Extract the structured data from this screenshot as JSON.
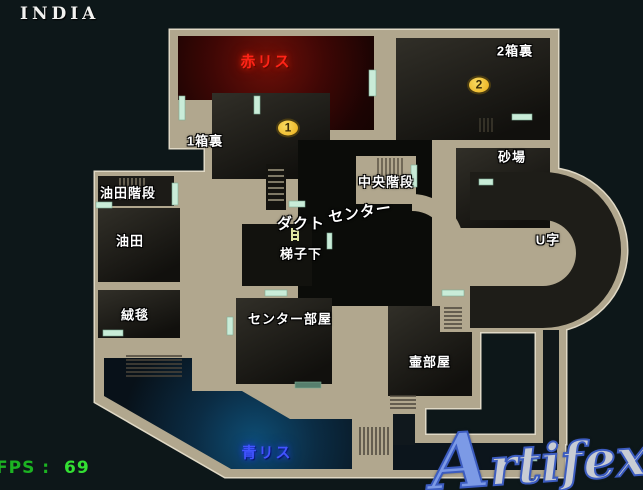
{
  "title": "INDIA",
  "hud": {
    "fps_label": "FPS :",
    "fps_value": "69"
  },
  "watermark": "Artifex",
  "spawns": {
    "red": {
      "label": "赤リス",
      "color": "#ff2418"
    },
    "blue": {
      "label": "青リス",
      "color": "#4254ff"
    }
  },
  "markers": [
    {
      "number": "1"
    },
    {
      "number": "2"
    }
  ],
  "rooms": [
    {
      "id": "2hako-ura",
      "label": "2箱裏"
    },
    {
      "id": "sunaba",
      "label": "砂場"
    },
    {
      "id": "1hako-ura",
      "label": "1箱裏"
    },
    {
      "id": "yuden-kaidan",
      "label": "油田階段"
    },
    {
      "id": "yuden",
      "label": "油田"
    },
    {
      "id": "juutan",
      "label": "絨毯"
    },
    {
      "id": "chuuou-kaidan",
      "label": "中央階段"
    },
    {
      "id": "center",
      "label": "センター"
    },
    {
      "id": "dakuto",
      "label": "ダクト"
    },
    {
      "id": "hashigo-shita",
      "label": "梯子下"
    },
    {
      "id": "center-heya",
      "label": "センター部屋"
    },
    {
      "id": "tsubo-heya",
      "label": "壷部屋"
    },
    {
      "id": "u-ji",
      "label": "U字"
    }
  ],
  "colors": {
    "background": "#0d1719",
    "wall": "#b1a78e",
    "wall_outline": "#e0d9c6",
    "door": "#c9ecd8",
    "marker": "#f2c53d",
    "fps_green": "#33e033",
    "watermark_blue": "#3c5cc0"
  }
}
